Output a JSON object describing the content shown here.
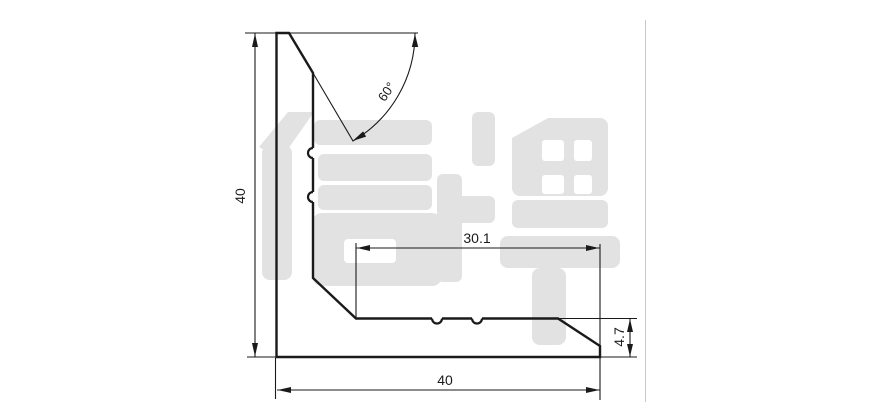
{
  "document": {
    "type": "technical-profile-drawing",
    "background": "#ffffff"
  },
  "watermark": {
    "text": "信牌",
    "color": "#e2e2e2"
  },
  "colors": {
    "line": "#1a1a1a",
    "faint_line": "#c9c9c9",
    "white": "#ffffff"
  },
  "dimensions": {
    "height": {
      "label": "40"
    },
    "width": {
      "label": "40"
    },
    "inner_width": {
      "label": "30.1"
    },
    "thickness": {
      "label": "4.7"
    },
    "angle": {
      "label": "60°"
    }
  }
}
